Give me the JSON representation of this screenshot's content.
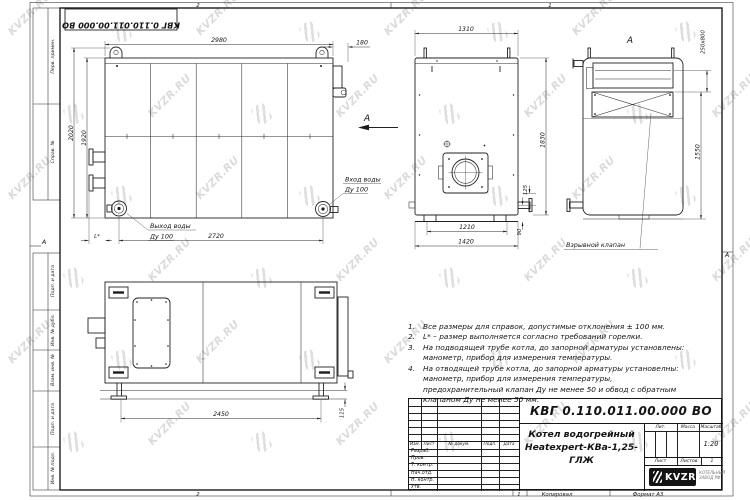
{
  "frame": {
    "doc_number_rotated": "КВГ 0.110.011.00.000 ВО",
    "zone_top_left": "2",
    "zone_top_right": "1",
    "zone_bottom_left": "2",
    "zone_bottom_right": "1",
    "fold_left": "А",
    "fold_right": "А",
    "copied": "Копировал",
    "format": "Формат А3",
    "stamps_top": [
      "Перв. примен.",
      "Справ. №"
    ],
    "stamps_bottom": [
      "Подп. и дата",
      "Инв. № дубл.",
      "Взам. инв. №",
      "Подп. и дата",
      "Инв. № подл."
    ]
  },
  "watermark": {
    "text": "KVZR.RU"
  },
  "views": {
    "front": {
      "dim_width": "2980",
      "dim_flue": "180",
      "dim_h1": "2020",
      "dim_h2": "1920",
      "dim_span": "2720",
      "dim_l": "L*",
      "label_out1": "Выход воды",
      "label_out2": "Ду 100",
      "label_in1": "Вход воды",
      "label_in2": "Ду 100",
      "view_mark": "А"
    },
    "side": {
      "dim_depth": "1310",
      "dim_height": "1830",
      "dim_125": "125",
      "dim_90": "90",
      "dim_1210": "1210",
      "dim_1420": "1420"
    },
    "rear": {
      "mark": "А",
      "dim_flue": "250x800",
      "dim_1550": "1550",
      "callout": "Взрывной клапан"
    },
    "plan": {
      "dim_2450": "2450",
      "dim_115": "115"
    }
  },
  "notes": {
    "numbers": [
      "1.",
      "2.",
      "3.",
      "4."
    ],
    "items": [
      "Все размеры для справок, допустимые отклонения ± 100 мм.",
      "L* – размер выполняется согласно требований горелки.",
      "На подводящей трубе котла, до запорной арматуры установлены: манометр, прибор для измерения температуры.",
      "На отводящей трубе котла, до запорной арматуры установелны: манометр, прибор для измерения температуры, предохранительный клапан Ду не менее 50 и обвод с обратным клапаном Ду не менее 50 мм."
    ]
  },
  "title_block": {
    "doc_number": "КВГ 0.110.011.00.000 ВО",
    "name_line1": "Котел водогрейный",
    "name_line2": "Heatexpert-КВа-1,25-ГЛЖ",
    "cols": [
      "Изм.",
      "Лист",
      "№ докум.",
      "Подп.",
      "Дата"
    ],
    "rows": [
      "Разраб.",
      "Пров.",
      "Т. контр.",
      "Нач.отд.",
      "Н. контр.",
      "Утв."
    ],
    "lit": "Лит.",
    "mass": "Масса",
    "scale": "Масштаб",
    "scale_value": "1:20",
    "sheet": "Лист",
    "sheets": "Листов",
    "sheets_value": "1",
    "logo_text": "KVZR",
    "company_line1": "КОТЕЛЬНЫЙ",
    "company_line2": "ЗАВОД РФ"
  }
}
